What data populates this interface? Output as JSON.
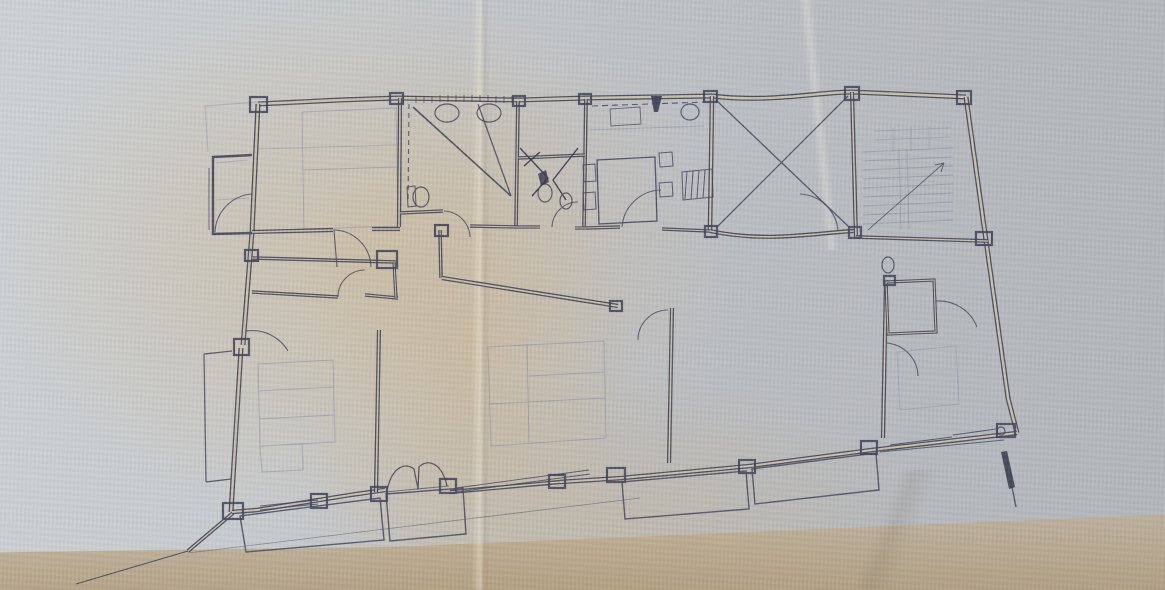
{
  "scene": {
    "type": "photograph of a hand-drawn architectural floor plan on aged folded paper",
    "visible_text": "none"
  },
  "palette": {
    "ink": "#3f4259",
    "ink_dark": "#2e3147",
    "pencil": "#8e91a8",
    "paper_line": "#cbc0a6",
    "paper_light": "#cdd1d4",
    "paper_mid": "#bdc0c4",
    "paper_dark": "#b2b5ba",
    "paper_tan": "#d1b88f",
    "paper_tan_dark": "#b39c78"
  },
  "plan": {
    "viewbox": "0 0 1165 590",
    "pencil": [
      {
        "name": "stair-treads",
        "d": "M863 152 L953 148 M863 161 L953 157 M863 170 L953 166 M863 179 L953 175 M863 188 L953 184 M863 197 L953 193 M863 206 L953 202 M863 215 L953 211 M863 224 L953 220",
        "w": 1,
        "o": 0.7
      },
      {
        "name": "stair-landing",
        "d": "M875 131 L950 128 M875 140 L950 137 M893 128 L893 152 M911 127 L911 151 M929 127 L929 150",
        "w": 1,
        "o": 0.55
      },
      {
        "name": "stair-rails",
        "d": "M899 150 L901 229 M907 150 L909 229",
        "w": 0.9,
        "o": 0.7
      },
      {
        "name": "bed-top-left",
        "d": "M302 112 L396 108 L398 226 L304 229 Z M302 170 L397 167",
        "w": 1,
        "o": 0.6
      },
      {
        "name": "pencil-line-top-left",
        "d": "M258 149 L396 145",
        "w": 1,
        "o": 0.5
      },
      {
        "name": "beds-center",
        "d": "M488 347 L604 341 L606 438 L491 446 Z M527 344 L529 442 M489 404 L605 398 M529 376 L605 372",
        "w": 1,
        "o": 0.65
      },
      {
        "name": "bed-left-bottom",
        "d": "M258 364 L333 360 L335 442 L260 446 Z M258 391 L334 387 M259 419 L334 415 M260 446 L302 444 L303 470 L262 472 Z",
        "w": 1,
        "o": 0.6
      },
      {
        "name": "bed-right",
        "d": "M897 352 L956 346 L959 404 L900 410 Z",
        "w": 1,
        "o": 0.5
      },
      {
        "name": "kitchen-counter-line",
        "d": "M588 130 L704 126",
        "w": 1,
        "o": 0.55
      },
      {
        "name": "bay-room-lines",
        "d": "M216 163 L248 160 M216 200 L249 198",
        "w": 1,
        "o": 0.5
      },
      {
        "name": "faint-ext-top-left",
        "d": "M258 102 L205 106 M205 106 L208 152",
        "w": 1,
        "o": 0.5
      }
    ],
    "walls": [
      {
        "name": "wall-top-left",
        "d": "M258 104 L340 100 L398 98",
        "w": 5,
        "double": true
      },
      {
        "name": "wall-top-mid",
        "d": "M398 98 L520 100 L586 98 L712 96",
        "w": 5,
        "double": true
      },
      {
        "name": "wall-top-courtyard",
        "d": "M712 96 C770 103 818 92 852 92",
        "w": 5,
        "double": true
      },
      {
        "name": "wall-top-stair",
        "d": "M852 92 L966 97",
        "w": 5,
        "double": true
      },
      {
        "name": "wall-right-outer",
        "d": "M966 97 L1008 398 L1017 433",
        "w": 5,
        "double": true
      },
      {
        "name": "wall-left-upper",
        "d": "M258 104 L252 232",
        "w": 5,
        "double": true
      },
      {
        "name": "wall-left-mid",
        "d": "M252 232 L243 345",
        "w": 5,
        "double": true
      },
      {
        "name": "wall-left-lower",
        "d": "M241 348 L231 512",
        "w": 5,
        "double": true
      },
      {
        "name": "wall-taper",
        "d": "M233 513 L188 551",
        "w": 4,
        "double": true
      },
      {
        "name": "wall-bottom-r1",
        "d": "M1017 433 L872 450",
        "w": 4.6,
        "double": true
      },
      {
        "name": "wall-bottom-r2",
        "d": "M872 450 L750 466",
        "w": 4.6,
        "double": true
      },
      {
        "name": "wall-bottom-r3",
        "d": "M750 466 L622 478",
        "w": 4.6,
        "double": true
      },
      {
        "name": "wall-bottom-r4",
        "d": "M622 478 L560 482",
        "w": 4.6,
        "double": true
      },
      {
        "name": "wall-bottom-window",
        "d": "M560 482 L450 492",
        "w": 4.2,
        "double": true
      },
      {
        "name": "wall-bottom-l1",
        "d": "M385 490 L350 495 L257 510 L232 512",
        "w": 4.6,
        "double": true
      },
      {
        "name": "wall-bay-left",
        "d": "M252 155 L213 157 L213 234 L252 233",
        "w": 2.4,
        "double": false
      },
      {
        "name": "wall-corridor-top-a",
        "d": "M252 232 L333 230",
        "w": 4.2,
        "double": true
      },
      {
        "name": "wall-corridor-top-b",
        "d": "M372 229 L400 229",
        "w": 4.2,
        "double": true
      },
      {
        "name": "wall-bath-left",
        "d": "M400 98 L399 227",
        "w": 4.2,
        "double": true
      },
      {
        "name": "wall-bath-right",
        "d": "M518 101 L516 227",
        "w": 3.8,
        "double": true
      },
      {
        "name": "wall-wc-right",
        "d": "M586 99 L584 228",
        "w": 3.8,
        "double": true
      },
      {
        "name": "wall-wc-divider",
        "d": "M518 158 L585 155",
        "w": 3.4,
        "double": true
      },
      {
        "name": "wall-kitchen-right",
        "d": "M712 96 L710 231",
        "w": 4.6,
        "double": true
      },
      {
        "name": "wall-courtyard-bottom",
        "d": "M710 231 C765 243 815 233 854 231",
        "w": 4.2,
        "double": true
      },
      {
        "name": "wall-stair-left",
        "d": "M852 92 L856 237",
        "w": 4.2,
        "double": true
      },
      {
        "name": "wall-stair-bottom",
        "d": "M856 237 L988 241",
        "w": 3.8,
        "double": true
      },
      {
        "name": "wall-corridor-1",
        "d": "M252 258 L396 262",
        "w": 3.6,
        "double": true
      },
      {
        "name": "wall-corridor-2",
        "d": "M252 292 L338 297",
        "w": 3.6,
        "double": true
      },
      {
        "name": "wall-corridor-2b",
        "d": "M365 295 L398 298",
        "w": 3.4,
        "double": true
      },
      {
        "name": "wall-corridor-stub",
        "d": "M394 262 L396 298",
        "w": 3.2,
        "double": true
      },
      {
        "name": "wall-hall-stub",
        "d": "M440 230 L441 278",
        "w": 3.6,
        "double": true
      },
      {
        "name": "wall-center-top",
        "d": "M442 278 L618 306",
        "w": 4.4,
        "double": true
      },
      {
        "name": "wall-center-left",
        "d": "M379 330 L376 492",
        "w": 4.2,
        "double": true
      },
      {
        "name": "wall-center-right",
        "d": "M672 308 L669 463",
        "w": 4.2,
        "double": true
      },
      {
        "name": "wall-right-interior",
        "d": "M886 280 L883 438",
        "w": 4.2,
        "double": true
      },
      {
        "name": "wall-closet",
        "d": "M886 282 L934 280 L936 332 L888 334 Z",
        "w": 3.2,
        "double": true
      },
      {
        "name": "wall-bath-bottom-a",
        "d": "M400 213 L443 211",
        "w": 3.4,
        "double": true
      },
      {
        "name": "wall-bath-bottom-b",
        "d": "M470 226 L518 227",
        "w": 3.4,
        "double": true
      },
      {
        "name": "wall-wc-bottom-a",
        "d": "M518 227 L540 227",
        "w": 3.2,
        "double": true
      },
      {
        "name": "wall-wc-bottom-b",
        "d": "M575 228 L586 228",
        "w": 3.2,
        "double": true
      },
      {
        "name": "wall-kitchen-bottom-a",
        "d": "M586 228 L620 227",
        "w": 3.6,
        "double": true
      },
      {
        "name": "wall-kitchen-bottom-b",
        "d": "M662 229 L710 231",
        "w": 3.6,
        "double": true
      }
    ],
    "blocks": [
      {
        "name": "pilaster-top-left",
        "x": 250,
        "y": 97,
        "w": 17,
        "h": 15
      },
      {
        "name": "pilaster-top-bath",
        "x": 390,
        "y": 93,
        "w": 13,
        "h": 11
      },
      {
        "name": "pilaster-top-kitchen",
        "x": 704,
        "y": 91,
        "w": 13,
        "h": 11
      },
      {
        "name": "pilaster-top-court",
        "x": 845,
        "y": 87,
        "w": 14,
        "h": 13
      },
      {
        "name": "pilaster-top-stair",
        "x": 957,
        "y": 91,
        "w": 14,
        "h": 13
      },
      {
        "name": "pilaster-right-1",
        "x": 976,
        "y": 232,
        "w": 16,
        "h": 13
      },
      {
        "name": "pilaster-corner-br",
        "x": 997,
        "y": 424,
        "w": 18,
        "h": 13
      },
      {
        "name": "pilaster-bottom-1",
        "x": 861,
        "y": 441,
        "w": 16,
        "h": 13
      },
      {
        "name": "pilaster-bottom-2",
        "x": 739,
        "y": 460,
        "w": 16,
        "h": 13
      },
      {
        "name": "pilaster-bottom-3",
        "x": 607,
        "y": 468,
        "w": 18,
        "h": 14
      },
      {
        "name": "pilaster-bottom-4",
        "x": 549,
        "y": 475,
        "w": 16,
        "h": 13
      },
      {
        "name": "pilaster-bottom-5",
        "x": 440,
        "y": 479,
        "w": 16,
        "h": 14
      },
      {
        "name": "pilaster-bottom-6",
        "x": 371,
        "y": 487,
        "w": 16,
        "h": 14
      },
      {
        "name": "pilaster-bottom-7",
        "x": 311,
        "y": 494,
        "w": 16,
        "h": 14
      },
      {
        "name": "pilaster-bottom-8",
        "x": 223,
        "y": 503,
        "w": 20,
        "h": 16
      },
      {
        "name": "pilaster-left-1",
        "x": 234,
        "y": 339,
        "w": 15,
        "h": 16
      },
      {
        "name": "pilaster-left-2",
        "x": 245,
        "y": 250,
        "w": 13,
        "h": 11
      },
      {
        "name": "pilaster-hall",
        "x": 377,
        "y": 251,
        "w": 20,
        "h": 17
      },
      {
        "name": "pilaster-hall-2",
        "x": 435,
        "y": 225,
        "w": 13,
        "h": 11
      },
      {
        "name": "pilaster-court-b",
        "x": 849,
        "y": 227,
        "w": 12,
        "h": 11
      },
      {
        "name": "pilaster-kitchen-b",
        "x": 705,
        "y": 226,
        "w": 12,
        "h": 11
      },
      {
        "name": "pilaster-center-top",
        "x": 610,
        "y": 301,
        "w": 12,
        "h": 10
      },
      {
        "name": "pilaster-wc-top",
        "x": 579,
        "y": 94,
        "w": 12,
        "h": 10
      },
      {
        "name": "pilaster-bath-top",
        "x": 513,
        "y": 96,
        "w": 12,
        "h": 10
      },
      {
        "name": "pilaster-closet",
        "x": 884,
        "y": 276,
        "w": 11,
        "h": 9
      }
    ],
    "lines": [
      {
        "name": "bath-dashed-screen",
        "d": "M409 104 L408 200",
        "w": 1.1,
        "o": 0.85,
        "dash": "5 4"
      },
      {
        "name": "kitchen-dashed-counter",
        "d": "M592 106 L706 102",
        "w": 1.1,
        "o": 0.85,
        "dash": "6 4"
      },
      {
        "name": "bath-diagonal-1",
        "d": "M413 107 L511 196",
        "w": 1.6,
        "o": 0.9
      },
      {
        "name": "bath-diagonal-2",
        "d": "M478 104 L511 196",
        "w": 1.3,
        "o": 0.85
      },
      {
        "name": "courtyard-x",
        "d": "M716 100 L849 227 M848 96 L717 227",
        "w": 1.3,
        "o": 0.85
      },
      {
        "name": "stair-arrow",
        "d": "M868 230 L944 163 M944 163 L935 165 M944 163 L941 172",
        "w": 1,
        "o": 0.75
      },
      {
        "name": "radiator-hatch",
        "d": "M682 172 L712 169 L713 197 L683 200 Z M687 172 L685 199 M693 171 L691 199 M699 171 L697 198 M705 170 L703 198",
        "w": 1,
        "o": 0.85
      },
      {
        "name": "kitchen-table",
        "d": "M597 160 L655 157 L657 221 L599 224 Z",
        "w": 1.3,
        "o": 0.9
      },
      {
        "name": "kitchen-chairs",
        "d": "M583 165 L595 164 L596 181 L584 182 Z M583 193 L595 192 L596 209 L584 210 Z M659 153 L672 152 L673 166 L660 167 Z M659 183 L672 182 L673 196 L660 197 Z",
        "w": 1,
        "o": 0.85
      },
      {
        "name": "kitchen-counter-box",
        "d": "M610 109 L640 107 L641 124 L611 126 Z",
        "w": 0.9,
        "o": 0.75
      },
      {
        "name": "louvre-ticks",
        "d": "M416 96 L416 103 M424 96 L424 103 M432 96 L432 103 M440 95 L440 102 M448 95 L448 102 M456 95 L456 102 M464 95 L464 102 M472 95 L472 102 M480 95 L480 102 M488 95 L488 102 M496 96 L496 103 M504 96 L504 103 M512 96 L512 103",
        "w": 0.8,
        "o": 0.8
      },
      {
        "name": "window-bottom-left",
        "d": "M260 506 L318 500 M260 510 L318 504",
        "w": 0.9,
        "o": 0.85
      },
      {
        "name": "window-bottom-center",
        "d": "M456 488 L589 470 M457 492 L590 474",
        "w": 0.9,
        "o": 0.85
      },
      {
        "name": "window-bottom-right",
        "d": "M890 445 L952 437 M953 435 L996 429",
        "w": 0.9,
        "o": 0.85
      },
      {
        "name": "bay-window-line",
        "d": "M209 168 L209 230",
        "w": 0.9,
        "o": 0.8
      },
      {
        "name": "balcony-left-bay",
        "d": "M204 354 L232 351 M204 354 L206 482 M206 482 L231 479",
        "w": 1.2,
        "o": 0.85
      },
      {
        "name": "balcony-left",
        "d": "M240 516 L380 498 L384 540 L246 552 Z",
        "w": 1.4,
        "o": 0.85
      },
      {
        "name": "balcony-entry",
        "d": "M386 494 L463 488 L466 534 L390 541 Z",
        "w": 1.4,
        "o": 0.85
      },
      {
        "name": "balcony-center",
        "d": "M622 482 L746 471 L749 509 L625 519 Z",
        "w": 1.4,
        "o": 0.85
      },
      {
        "name": "balcony-right",
        "d": "M752 469 L876 453 L879 490 L755 504 Z",
        "w": 1.4,
        "o": 0.85
      },
      {
        "name": "balcony-edge-right",
        "d": "M880 452 L1004 440",
        "w": 1.1,
        "o": 0.8
      },
      {
        "name": "taper-point-line",
        "d": "M188 551 L76 584",
        "w": 1.1,
        "o": 0.9
      },
      {
        "name": "under-balcony-line",
        "d": "M188 553 L640 498",
        "w": 0.8,
        "o": 0.5
      },
      {
        "name": "butterfly-door",
        "d": "M387 491 C391 469 404 461 414 469 L418 489 M447 486 C442 463 428 458 419 467 L418 489",
        "w": 1.2,
        "o": 0.9
      },
      {
        "name": "entry-sill",
        "d": "M385 492 L449 486",
        "w": 0.9,
        "o": 0.7
      },
      {
        "name": "wc-fixture-scribble",
        "d": "M520 148 L548 178 M548 178 L532 196 M578 148 L553 180 M553 180 L566 200 M524 166 L540 152",
        "w": 1.4,
        "o": 0.9,
        "c": "ink_dark"
      },
      {
        "name": "door-leaf-bedroom",
        "d": "M334 231 L337 267",
        "w": 1.1,
        "o": 0.85
      },
      {
        "name": "toilet-tank",
        "d": "M407 187 L415 186 L416 206 L408 207 Z",
        "w": 1,
        "o": 0.85
      },
      {
        "name": "pen-mark-tail",
        "d": "M1012 487 L1016 507",
        "w": 1.4,
        "o": 0.85
      }
    ],
    "arcs": [
      {
        "name": "door-arc-bath",
        "d": "M444 211 A27 27 0 0 1 470 237"
      },
      {
        "name": "door-arc-wc",
        "d": "M552 227 A26 26 0 0 1 578 202"
      },
      {
        "name": "door-arc-kitchen",
        "d": "M622 227 A40 40 0 0 1 661 190"
      },
      {
        "name": "door-arc-corridor",
        "d": "M338 297 A27 27 0 0 1 365 270"
      },
      {
        "name": "door-arc-bedroom-tl",
        "d": "M333 230 A38 38 0 0 1 371 267"
      },
      {
        "name": "door-arc-bay",
        "d": "M215 232 A40 40 0 0 1 252 194"
      },
      {
        "name": "door-arc-center",
        "d": "M668 310 A30 30 0 0 0 638 340"
      },
      {
        "name": "door-arc-bedroom-lb",
        "d": "M246 331 A42 42 0 0 1 288 351"
      },
      {
        "name": "door-arc-right-room",
        "d": "M936 301 A41 41 0 0 1 977 327"
      },
      {
        "name": "door-arc-right-room-2",
        "d": "M886 343 A34 34 0 0 1 918 376"
      },
      {
        "name": "door-arc-courtyard",
        "d": "M838 231 A40 40 0 0 0 800 194"
      }
    ],
    "ellipses": [
      {
        "name": "sink-1",
        "cx": 447,
        "cy": 113,
        "rx": 12,
        "ry": 9
      },
      {
        "name": "sink-2",
        "cx": 489,
        "cy": 113,
        "rx": 12,
        "ry": 9
      },
      {
        "name": "toilet-bath",
        "cx": 421,
        "cy": 197,
        "rx": 8,
        "ry": 10
      },
      {
        "name": "toilet-wc",
        "cx": 545,
        "cy": 193,
        "rx": 7,
        "ry": 9
      },
      {
        "name": "bidet-wc",
        "cx": 566,
        "cy": 201,
        "rx": 6,
        "ry": 8
      },
      {
        "name": "kitchen-sink",
        "cx": 690,
        "cy": 112,
        "rx": 9,
        "ry": 8
      },
      {
        "name": "toilet-right",
        "cx": 888,
        "cy": 265,
        "rx": 6,
        "ry": 8
      },
      {
        "name": "corner-mark",
        "cx": 1001,
        "cy": 431,
        "rx": 4,
        "ry": 4
      }
    ],
    "fills": [
      {
        "name": "bell-symbol",
        "d": "M651 96 L662 96 L658 112 L654 112 Z",
        "o": 0.85
      },
      {
        "name": "pen-mark",
        "d": "M1001 452 L1007 451 L1015 487 L1009 489 Z",
        "o": 0.85
      },
      {
        "name": "wc-dark-blob",
        "d": "M538 174 L546 170 L549 182 L541 186 Z",
        "o": 0.8
      }
    ]
  }
}
